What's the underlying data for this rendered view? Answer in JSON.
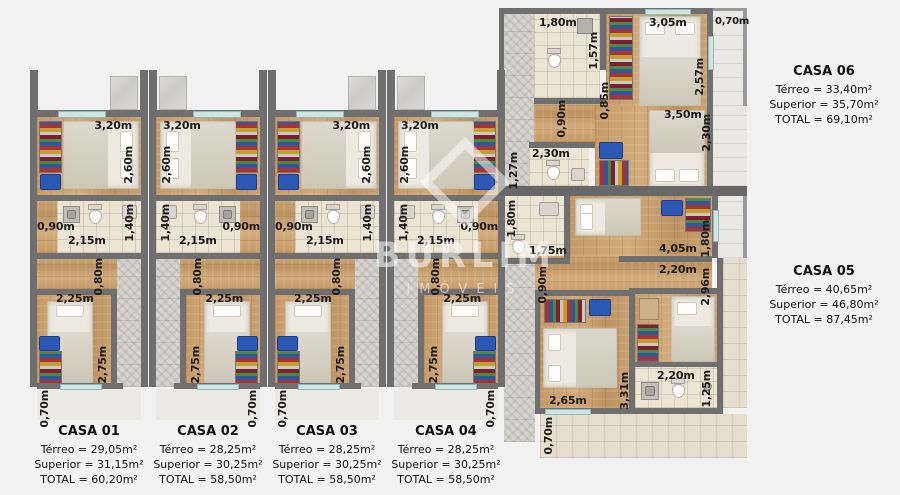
{
  "watermark": {
    "name": "BURLIM",
    "subtitle": "IMÓVEIS"
  },
  "left_units": {
    "dims": {
      "bedroom_width": "3,20m",
      "bedroom_depth": "2,60m",
      "entry_width": "0,90m",
      "bath_width": "2,15m",
      "bath_depth": "1,40m",
      "hall_width": "0,80m",
      "bedroom2_width": "2,25m",
      "bedroom2_depth": "2,75m",
      "porch_depth": "0,70m"
    },
    "units": [
      {
        "name": "CASA 01",
        "terreo": "Térreo = 29,05m²",
        "superior": "Superior = 31,15m²",
        "total": "TOTAL = 60,20m²"
      },
      {
        "name": "CASA 02",
        "terreo": "Térreo = 28,25m²",
        "superior": "Superior = 30,25m²",
        "total": "TOTAL = 58,50m²"
      },
      {
        "name": "CASA 03",
        "terreo": "Térreo = 28,25m²",
        "superior": "Superior = 30,25m²",
        "total": "TOTAL = 58,50m²"
      },
      {
        "name": "CASA 04",
        "terreo": "Térreo = 28,25m²",
        "superior": "Superior = 30,25m²",
        "total": "TOTAL = 58,50m²"
      }
    ]
  },
  "casa06": {
    "name": "CASA 06",
    "terreo": "Térreo = 33,40m²",
    "superior": "Superior = 35,70m²",
    "total": "TOTAL = 69,10m²",
    "dims": {
      "bath1_width": "1,80m",
      "bath1_depth": "1,57m",
      "bedroom1_width": "3,05m",
      "balcony_width": "0,70m",
      "bedroom1_depth": "2,57m",
      "hall_depth": "0,85m",
      "hall2_depth": "0,90m",
      "bath2_width": "2,30m",
      "bath2_depth": "1,27m",
      "bedroom2_width": "3,50m",
      "bedroom2_depth": "2,30m"
    }
  },
  "casa05": {
    "name": "CASA 05",
    "terreo": "Térreo = 40,65m²",
    "superior": "Superior = 46,80m²",
    "total": "TOTAL = 87,45m²",
    "dims": {
      "bath1_depth": "1,80m",
      "bath1_width": "1,75m",
      "bedroom1_width": "4,05m",
      "bedroom1_depth": "1,80m",
      "hall_width": "2,20m",
      "side_depth": "2,96m",
      "hall_depth": "0,90m",
      "bedroom2_width": "2,65m",
      "bedroom2_depth": "3,31m",
      "bath2_width": "2,20m",
      "bath2_depth": "1,25m",
      "porch_depth": "0,70m"
    }
  }
}
